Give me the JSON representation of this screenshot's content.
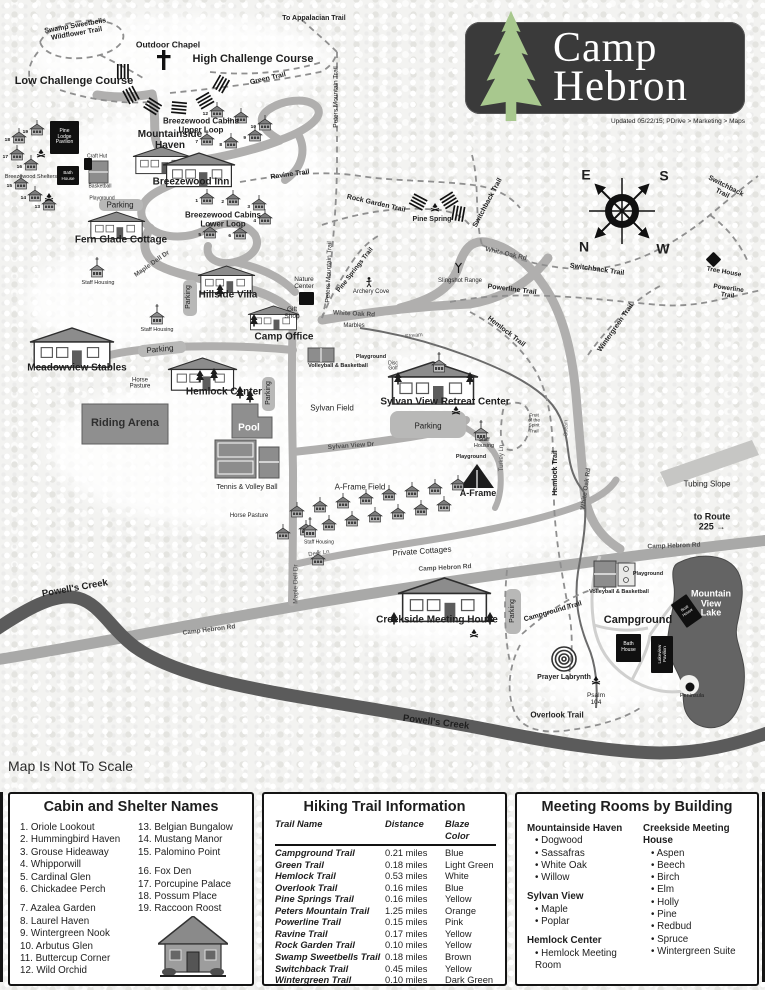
{
  "logo": {
    "line1": "Camp",
    "line2": "Hebron",
    "updated": "Updated 05/22/15; PDrive > Marketing > Maps"
  },
  "map_note": "Map Is Not To Scale",
  "compass": {
    "e": "E",
    "s": "S",
    "n": "N",
    "w": "W"
  },
  "map": {
    "labels": [
      {
        "t": "Swamp Sweetbells\nWildflower Trail",
        "x": 76,
        "y": 30,
        "r": -10,
        "s": 7,
        "w": 700
      },
      {
        "t": "Outdoor Chapel",
        "x": 168,
        "y": 45,
        "s": 8.5,
        "w": 700
      },
      {
        "t": "High Challenge Course",
        "x": 253,
        "y": 60,
        "s": 11,
        "w": 700
      },
      {
        "t": "Low Challenge Course",
        "x": 74,
        "y": 82,
        "s": 11,
        "w": 700
      },
      {
        "t": "To Appalacian Trail",
        "x": 314,
        "y": 19,
        "s": 7,
        "w": 700
      },
      {
        "t": "Green Trail",
        "x": 268,
        "y": 79,
        "r": -13,
        "s": 7,
        "w": 700
      },
      {
        "t": "Peters Mountain Trail",
        "x": 336,
        "y": 97,
        "r": -90,
        "s": 6.5
      },
      {
        "t": "Peters Mountain Trail",
        "x": 329,
        "y": 272,
        "r": -88,
        "s": 6.5
      },
      {
        "t": "Breezewood Cabins\nUpper Loop",
        "x": 201,
        "y": 126,
        "s": 8,
        "w": 700
      },
      {
        "t": "Breezewood Shelters",
        "x": 31,
        "y": 178,
        "s": 5.5
      },
      {
        "t": "Craft Hut",
        "x": 97,
        "y": 157,
        "s": 5
      },
      {
        "t": "Basketball",
        "x": 100,
        "y": 187,
        "s": 5
      },
      {
        "t": "Playground",
        "x": 102,
        "y": 199,
        "s": 5
      },
      {
        "t": "Mountainside\nHaven",
        "x": 170,
        "y": 141,
        "s": 10,
        "w": 700
      },
      {
        "t": "Breezewood Inn",
        "x": 191,
        "y": 183,
        "s": 10,
        "w": 700
      },
      {
        "t": "Parking",
        "x": 120,
        "y": 206,
        "s": 8
      },
      {
        "t": "Fern Glade Cottage",
        "x": 121,
        "y": 241,
        "s": 10,
        "w": 700
      },
      {
        "t": "Breezewood Cabins\nLower Loop",
        "x": 223,
        "y": 220,
        "s": 8,
        "w": 700
      },
      {
        "t": "Ravine Trail",
        "x": 290,
        "y": 175,
        "r": -8,
        "s": 7,
        "w": 700
      },
      {
        "t": "Staff Housing",
        "x": 98,
        "y": 284,
        "s": 5.5
      },
      {
        "t": "Maple Dell Dr",
        "x": 152,
        "y": 264,
        "r": -35,
        "s": 6.5,
        "c": "#4f4f4f",
        "w": 700
      },
      {
        "t": "Parking",
        "x": 189,
        "y": 297,
        "r": -90,
        "s": 7
      },
      {
        "t": "Hillside Villa",
        "x": 228,
        "y": 296,
        "s": 10,
        "w": 700
      },
      {
        "t": "Staff Housing",
        "x": 157,
        "y": 331,
        "s": 5.5
      },
      {
        "t": "Meadowview Stables",
        "x": 77,
        "y": 369,
        "s": 10,
        "w": 700
      },
      {
        "t": "Parking",
        "x": 160,
        "y": 350,
        "r": -6,
        "s": 8
      },
      {
        "t": "Horse\nPasture",
        "x": 140,
        "y": 384,
        "s": 6
      },
      {
        "t": "Hemlock Center",
        "x": 224,
        "y": 393,
        "s": 10,
        "w": 700
      },
      {
        "t": "Parking",
        "x": 269,
        "y": 393,
        "r": -90,
        "s": 7
      },
      {
        "t": "Riding Arena",
        "x": 125,
        "y": 424,
        "s": 11,
        "w": 700,
        "c": "#2e2e2e"
      },
      {
        "t": "Pool",
        "x": 249,
        "y": 429,
        "s": 10,
        "w": 700,
        "c": "#ffffff"
      },
      {
        "t": "Tennis & Volley Ball",
        "x": 247,
        "y": 488,
        "s": 7
      },
      {
        "t": "Horse Pasture",
        "x": 249,
        "y": 516,
        "s": 6
      },
      {
        "t": "Nature\nCenter",
        "x": 304,
        "y": 283,
        "s": 6.5
      },
      {
        "t": "Gift\nShop",
        "x": 292,
        "y": 313,
        "s": 6.5
      },
      {
        "t": "Camp Office",
        "x": 284,
        "y": 338,
        "s": 10,
        "w": 700
      },
      {
        "t": "Pine Springs Trail",
        "x": 355,
        "y": 270,
        "r": -52,
        "s": 6.5,
        "w": 700
      },
      {
        "t": "White Oak Rd",
        "x": 354,
        "y": 314,
        "r": 3,
        "s": 6.5,
        "w": 700,
        "c": "#4f4f4f"
      },
      {
        "t": "Marbles",
        "x": 354,
        "y": 326,
        "s": 6
      },
      {
        "t": "Archery Cove",
        "x": 371,
        "y": 292,
        "s": 6
      },
      {
        "t": "Slingshot Range",
        "x": 460,
        "y": 281,
        "s": 6
      },
      {
        "t": "Rock Garden Trail",
        "x": 376,
        "y": 204,
        "r": 13,
        "s": 7,
        "w": 700
      },
      {
        "t": "Pine Spring",
        "x": 432,
        "y": 220,
        "s": 7,
        "w": 700
      },
      {
        "t": "Switchback Trail",
        "x": 488,
        "y": 203,
        "r": -62,
        "s": 7,
        "w": 700
      },
      {
        "t": "Switchback Trail",
        "x": 724,
        "y": 190,
        "r": 27,
        "s": 7,
        "w": 700
      },
      {
        "t": "Switchback Trail",
        "x": 597,
        "y": 270,
        "r": 8,
        "s": 7,
        "w": 700
      },
      {
        "t": "Tree House",
        "x": 724,
        "y": 272,
        "r": 10,
        "s": 6.5,
        "w": 700
      },
      {
        "t": "Powerline Trail",
        "x": 512,
        "y": 290,
        "r": 7,
        "s": 7,
        "w": 700
      },
      {
        "t": "Powerline Trail",
        "x": 728,
        "y": 292,
        "r": 8,
        "s": 6.5,
        "w": 700
      },
      {
        "t": "Hemlock Trail",
        "x": 506,
        "y": 332,
        "r": 38,
        "s": 7,
        "w": 700
      },
      {
        "t": "Wintergreen Trail",
        "x": 616,
        "y": 328,
        "r": -55,
        "s": 7,
        "w": 700
      },
      {
        "t": "White Oak Rd",
        "x": 506,
        "y": 254,
        "r": 13,
        "s": 6.5,
        "w": 700,
        "c": "#4f4f4f"
      },
      {
        "t": "Stream",
        "x": 414,
        "y": 337,
        "r": -6,
        "s": 5.5,
        "c": "#555555"
      },
      {
        "t": "Playground",
        "x": 371,
        "y": 358,
        "s": 5.5,
        "w": 700
      },
      {
        "t": "Volleyball & Basketball",
        "x": 338,
        "y": 367,
        "s": 5.5,
        "w": 700
      },
      {
        "t": "Disc\nGolf",
        "x": 393,
        "y": 367,
        "s": 5
      },
      {
        "t": "Sylvan Field",
        "x": 332,
        "y": 409,
        "s": 8
      },
      {
        "t": "Sylvan View Dr",
        "x": 351,
        "y": 446,
        "r": -4,
        "s": 6.5,
        "c": "#4f4f4f",
        "w": 700
      },
      {
        "t": "A-Frame Field",
        "x": 360,
        "y": 488,
        "s": 8
      },
      {
        "t": "Sylvan View Retreat Center",
        "x": 445,
        "y": 403,
        "s": 10,
        "w": 700
      },
      {
        "t": "Parking",
        "x": 428,
        "y": 427,
        "s": 8
      },
      {
        "t": "Staff\nHousing",
        "x": 484,
        "y": 444,
        "s": 5.5
      },
      {
        "t": "Playground",
        "x": 471,
        "y": 458,
        "s": 5.5,
        "w": 700
      },
      {
        "t": "Turkey Ln",
        "x": 502,
        "y": 458,
        "r": -90,
        "s": 6,
        "c": "#4f4f4f"
      },
      {
        "t": "Fruit\nof the\nSpirit\nTrail",
        "x": 534,
        "y": 424,
        "s": 4.8
      },
      {
        "t": "A-Frame",
        "x": 478,
        "y": 494,
        "s": 9,
        "w": 700
      },
      {
        "t": "Hemlock Trail",
        "x": 556,
        "y": 473,
        "r": -90,
        "s": 7,
        "w": 700
      },
      {
        "t": "Stream",
        "x": 567,
        "y": 428,
        "r": -90,
        "s": 5,
        "c": "#555555"
      },
      {
        "t": "White Oak Rd",
        "x": 586,
        "y": 489,
        "r": -82,
        "s": 6.5,
        "w": 700,
        "c": "#4f4f4f"
      },
      {
        "t": "Tubing Slope",
        "x": 707,
        "y": 485,
        "s": 8
      },
      {
        "t": "to Route 225  →",
        "x": 712,
        "y": 522,
        "s": 9,
        "w": 700
      },
      {
        "t": "Camp Hebron Rd",
        "x": 209,
        "y": 630,
        "r": -7,
        "s": 6.5,
        "w": 700,
        "c": "#4f4f4f"
      },
      {
        "t": "Camp Hebron Rd",
        "x": 445,
        "y": 568,
        "r": -3,
        "s": 6.5,
        "w": 700,
        "c": "#4f4f4f"
      },
      {
        "t": "Camp Hebron Rd",
        "x": 674,
        "y": 546,
        "r": -2,
        "s": 6.5,
        "w": 700,
        "c": "#4f4f4f"
      },
      {
        "t": "Staff Housing",
        "x": 319,
        "y": 543,
        "s": 5
      },
      {
        "t": "Deer Ln",
        "x": 319,
        "y": 554,
        "r": -8,
        "s": 6,
        "c": "#4f4f4f"
      },
      {
        "t": "Private Cottages",
        "x": 422,
        "y": 552,
        "r": -4,
        "s": 8
      },
      {
        "t": "Maple Dell Dr",
        "x": 296,
        "y": 584,
        "r": -90,
        "s": 6.5,
        "c": "#4f4f4f"
      },
      {
        "t": "Creekside Meeting House",
        "x": 437,
        "y": 621,
        "s": 10,
        "w": 700
      },
      {
        "t": "Parking",
        "x": 513,
        "y": 611,
        "r": -90,
        "s": 7
      },
      {
        "t": "Campground Trail",
        "x": 553,
        "y": 612,
        "r": -16,
        "s": 7,
        "w": 700
      },
      {
        "t": "Campground",
        "x": 638,
        "y": 621,
        "s": 11,
        "w": 700
      },
      {
        "t": "Playground",
        "x": 648,
        "y": 575,
        "s": 5.5,
        "w": 700
      },
      {
        "t": "Volleyball & Basketball",
        "x": 619,
        "y": 593,
        "s": 5.5,
        "w": 700
      },
      {
        "t": "Prayer Labrynth",
        "x": 564,
        "y": 678,
        "s": 7,
        "w": 700
      },
      {
        "t": "Psalm\n104",
        "x": 596,
        "y": 699,
        "s": 6.5
      },
      {
        "t": "Overlook Trail",
        "x": 557,
        "y": 716,
        "s": 8,
        "w": 700
      },
      {
        "t": "Peninsula",
        "x": 692,
        "y": 697,
        "s": 5.5
      },
      {
        "t": "Powell's Creek",
        "x": 75,
        "y": 589,
        "r": -10,
        "s": 9.5,
        "w": 700
      },
      {
        "t": "Powell's Creek",
        "x": 436,
        "y": 723,
        "r": 7,
        "s": 9.5,
        "w": 700
      },
      {
        "t": "Mountain\nView\nLake",
        "x": 711,
        "y": 604,
        "s": 9,
        "w": 700,
        "c": "#ffffff"
      },
      {
        "t": "E",
        "x": 586,
        "y": 175,
        "s": 14,
        "w": 700
      },
      {
        "t": "S",
        "x": 664,
        "y": 176,
        "s": 14,
        "w": 700
      },
      {
        "t": "N",
        "x": 584,
        "y": 247,
        "s": 14,
        "w": 700
      },
      {
        "t": "W",
        "x": 663,
        "y": 249,
        "s": 14,
        "w": 700
      }
    ],
    "black_boxes": [
      {
        "t": "Pine\nLodge\nPavilion",
        "x": 50,
        "y": 121,
        "w": 29,
        "h": 33,
        "s": 5
      },
      {
        "t": "Bath\nHouse",
        "x": 57,
        "y": 166,
        "w": 22,
        "h": 19,
        "s": 4.5
      },
      {
        "t": "",
        "x": 84,
        "y": 158,
        "w": 8,
        "h": 12
      },
      {
        "t": "",
        "x": 299,
        "y": 292,
        "w": 15,
        "h": 13
      },
      {
        "t": "Bath\nHouse",
        "x": 616,
        "y": 634,
        "w": 25,
        "h": 28,
        "s": 5
      },
      {
        "t": "Lakeview\nPavilion",
        "x": 651,
        "y": 636,
        "w": 22,
        "h": 37,
        "s": 4.5,
        "vert": true
      },
      {
        "t": "Boat\nHouse",
        "x": 677,
        "y": 597,
        "w": 19,
        "h": 28,
        "s": 4,
        "rot": -35
      },
      {
        "t": "",
        "x": 708,
        "y": 254,
        "w": 11,
        "h": 11,
        "rot": 45
      }
    ],
    "cabins": [
      {
        "x": 210,
        "y": 106,
        "n": "12"
      },
      {
        "x": 234,
        "y": 112,
        "n": "11"
      },
      {
        "x": 258,
        "y": 119,
        "n": "10"
      },
      {
        "x": 200,
        "y": 134,
        "n": "7"
      },
      {
        "x": 224,
        "y": 137,
        "n": "8"
      },
      {
        "x": 248,
        "y": 130,
        "n": "9"
      },
      {
        "x": 200,
        "y": 193,
        "n": "1"
      },
      {
        "x": 226,
        "y": 194,
        "n": "2"
      },
      {
        "x": 252,
        "y": 199,
        "n": "3"
      },
      {
        "x": 258,
        "y": 213,
        "n": "4"
      },
      {
        "x": 203,
        "y": 227,
        "n": "5"
      },
      {
        "x": 233,
        "y": 228,
        "n": "6"
      },
      {
        "x": 30,
        "y": 124,
        "n": "19"
      },
      {
        "x": 12,
        "y": 132,
        "n": "18"
      },
      {
        "x": 10,
        "y": 149,
        "n": "17"
      },
      {
        "x": 24,
        "y": 159,
        "n": "16"
      },
      {
        "x": 14,
        "y": 178,
        "n": "15"
      },
      {
        "x": 28,
        "y": 190,
        "n": "14"
      },
      {
        "x": 42,
        "y": 199,
        "n": "13"
      },
      {
        "x": 290,
        "y": 506
      },
      {
        "x": 313,
        "y": 501
      },
      {
        "x": 336,
        "y": 497
      },
      {
        "x": 359,
        "y": 493
      },
      {
        "x": 382,
        "y": 489
      },
      {
        "x": 405,
        "y": 486
      },
      {
        "x": 428,
        "y": 483
      },
      {
        "x": 451,
        "y": 479
      },
      {
        "x": 276,
        "y": 528
      },
      {
        "x": 299,
        "y": 524
      },
      {
        "x": 322,
        "y": 519
      },
      {
        "x": 345,
        "y": 515
      },
      {
        "x": 368,
        "y": 511
      },
      {
        "x": 391,
        "y": 508
      },
      {
        "x": 414,
        "y": 504
      },
      {
        "x": 437,
        "y": 500
      },
      {
        "x": 311,
        "y": 554
      }
    ],
    "churches": [
      {
        "x": 90,
        "y": 265
      },
      {
        "x": 150,
        "y": 312
      },
      {
        "x": 474,
        "y": 428
      },
      {
        "x": 303,
        "y": 525
      },
      {
        "x": 432,
        "y": 360
      }
    ],
    "icons": [
      {
        "k": "fire",
        "x": 37,
        "y": 149
      },
      {
        "k": "fire",
        "x": 45,
        "y": 193
      },
      {
        "k": "fire",
        "x": 431,
        "y": 203
      },
      {
        "k": "fire",
        "x": 452,
        "y": 406
      },
      {
        "k": "fire",
        "x": 470,
        "y": 629
      },
      {
        "k": "fire",
        "x": 592,
        "y": 676
      },
      {
        "k": "person",
        "x": 366,
        "y": 277
      },
      {
        "k": "sling",
        "x": 455,
        "y": 263
      }
    ]
  },
  "panels": {
    "cabins": {
      "title": "Cabin and Shelter Names",
      "col1": [
        "1. Oriole Lookout",
        "2. Hummingbird Haven",
        "3. Grouse Hideaway",
        "4. Whipporwill",
        "5. Cardinal Glen",
        "6. Chickadee Perch",
        "",
        "7. Azalea Garden",
        "8. Laurel Haven",
        "9. Wintergreen Nook",
        "10. Arbutus Glen",
        "11. Buttercup Corner",
        "12. Wild Orchid"
      ],
      "col2": [
        "13. Belgian Bungalow",
        "14. Mustang Manor",
        "15. Palomino Point",
        "",
        "16. Fox Den",
        "17. Porcupine Palace",
        "18. Possum Place",
        "19. Raccoon Roost"
      ]
    },
    "trails": {
      "title": "Hiking Trail Information",
      "headers": [
        "Trail Name",
        "Distance",
        "Blaze Color"
      ],
      "rows": [
        [
          "Campground Trail",
          "0.21 miles",
          "Blue"
        ],
        [
          "Green Trail",
          "0.18 miles",
          "Light Green"
        ],
        [
          "Hemlock Trail",
          "0.53 miles",
          "White"
        ],
        [
          "Overlook Trail",
          "0.16 miles",
          "Blue"
        ],
        [
          "Pine Springs Trail",
          "0.16 miles",
          "Yellow"
        ],
        [
          "Peters Mountain Trail",
          "1.25 miles",
          "Orange"
        ],
        [
          "Powerline Trail",
          "0.15 miles",
          "Pink"
        ],
        [
          "Ravine Trail",
          "0.17 miles",
          "Yellow"
        ],
        [
          "Rock Garden Trail",
          "0.10 miles",
          "Yellow"
        ],
        [
          "Swamp Sweetbells  Trail",
          "0.18 miles",
          "Brown"
        ],
        [
          "Switchback Trail",
          "0.45 miles",
          "Yellow"
        ],
        [
          "Wintergreen Trail",
          "0.10 miles",
          "Dark Green"
        ]
      ]
    },
    "rooms": {
      "title": "Meeting Rooms by Building",
      "left": [
        {
          "building": "Mountainside Haven",
          "rooms": [
            "Dogwood",
            "Sassafras",
            "White Oak",
            "Willow"
          ]
        },
        {
          "building": "Sylvan View",
          "rooms": [
            "Maple",
            "Poplar"
          ]
        },
        {
          "building": "Hemlock Center",
          "rooms": [
            "Hemlock Meeting Room"
          ]
        }
      ],
      "right": [
        {
          "building": "Creekside Meeting House",
          "rooms": [
            "Aspen",
            "Beech",
            "Birch",
            "Elm",
            "Holly",
            "Pine",
            "Redbud",
            "Spruce",
            "Wintergreen Suite"
          ]
        }
      ]
    }
  }
}
